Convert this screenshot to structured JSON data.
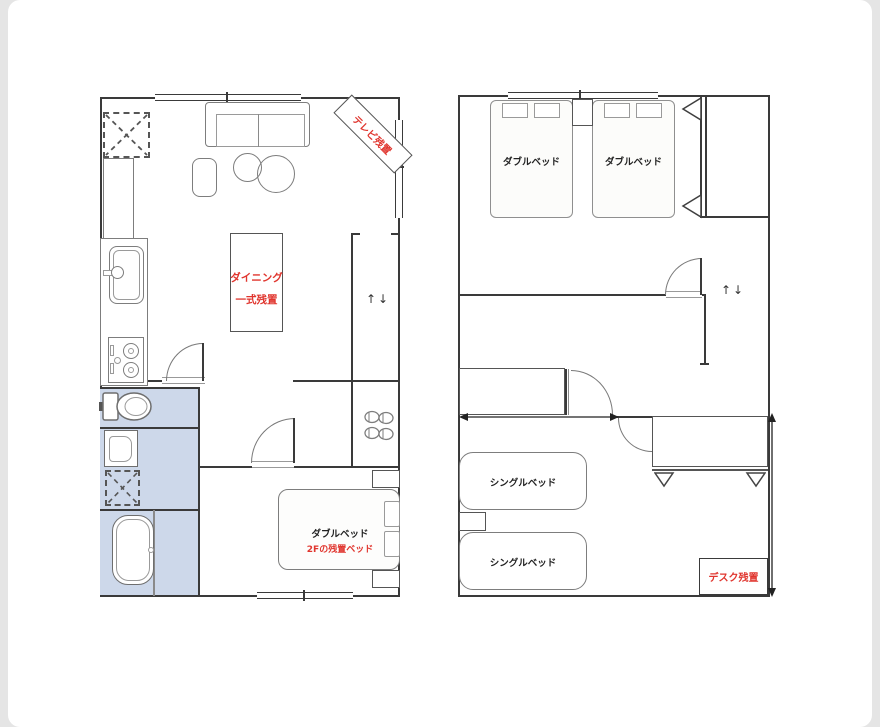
{
  "palette": {
    "frame_background": "#e5e5e5",
    "page_background": "#ffffff",
    "wall_color": "#3a3a3a",
    "furniture_color": "#7d7d7d",
    "wet_area_fill": "#cdd8ea",
    "accent_red": "#e0352e",
    "label_color": "#222222"
  },
  "floor1": {
    "tv_note": "テレビ残置",
    "dining_note_line1": "ダイニング",
    "dining_note_line2": "一式残置",
    "stairs_arrows": "↑↓",
    "double_bed_label": "ダブルベッド",
    "double_bed_note": "2Fの残置ベッド"
  },
  "floor2": {
    "double_bed_1_label": "ダブルベッド",
    "double_bed_2_label": "ダブルベッド",
    "stairs_arrows": "↑↓",
    "single_bed_1_label": "シングルベッド",
    "single_bed_2_label": "シングルベッド",
    "desk_note": "デスク残置"
  }
}
